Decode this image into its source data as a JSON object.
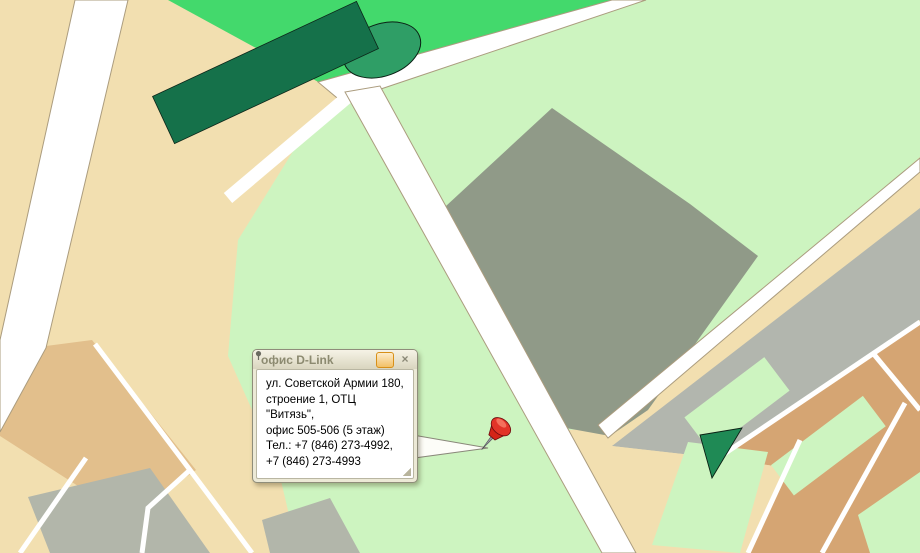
{
  "popup": {
    "title": "офис D-Link",
    "lines": [
      "ул. Советской Армии 180,",
      "строение 1, ОТЦ \"Витязь\",",
      "офис 505-506 (5 этаж)",
      "Тел.: +7 (846) 273-4992,",
      "+7 (846) 273-4993"
    ],
    "close_label": "×",
    "icons": {
      "pin_button": "pushpin-icon",
      "close_button": "close-icon"
    }
  },
  "colors": {
    "background_beige": "#f2dfb0",
    "park_green": "#43d96c",
    "residential_green": "#cdf4c0",
    "industrial_gray": "#909a88",
    "railway_gray": "#b2b6ae",
    "suburb_tan": "#d5a573",
    "street_label_red": "#a5161c",
    "marked_building_red": "#cf1d2c",
    "bus_stop_blue": "#2334d6",
    "traffic_light": [
      "#f01800",
      "#ffd800",
      "#2ecc10"
    ]
  },
  "map": {
    "street_labels": [
      {
        "text": "Московское шоссе",
        "x": 43,
        "y": 233,
        "rot": -63,
        "cls": "major"
      },
      {
        "text": "Стара Загора",
        "x": 534,
        "y": 42,
        "rot": -27,
        "cls": "major"
      },
      {
        "text": "проспект Карла Маркса",
        "x": 845,
        "y": 237,
        "rot": -37,
        "cls": "major"
      },
      {
        "text": "Фуражный пер.",
        "x": 146,
        "y": 392,
        "rot": 47,
        "cls": "minor"
      },
      {
        "text": "Центральная",
        "x": 40,
        "y": 523,
        "rot": -37,
        "cls": "minor"
      },
      {
        "text": "Са",
        "x": 150,
        "y": 533,
        "rot": 70,
        "cls": "major"
      },
      {
        "text": "Лоцманский пер.",
        "x": 838,
        "y": 503,
        "rot": 57,
        "cls": "minor"
      },
      {
        "text": "Свияжский п.",
        "x": 795,
        "y": 525,
        "rot": 57,
        "cls": "minor"
      },
      {
        "text": "Смол.",
        "x": 910,
        "y": 436,
        "rot": 57,
        "cls": "minor"
      }
    ],
    "building_labels": [
      {
        "text": "27",
        "x": 414,
        "y": 176
      },
      {
        "text": "27",
        "x": 441,
        "y": 153
      },
      {
        "text": "27",
        "x": 457,
        "y": 142
      },
      {
        "text": "77",
        "x": 224,
        "y": 74
      },
      {
        "text": "77",
        "x": 176,
        "y": 105
      },
      {
        "text": "77",
        "x": 148,
        "y": 125
      },
      {
        "text": "21",
        "x": 303,
        "y": 223
      },
      {
        "text": "23",
        "x": 332,
        "y": 237
      },
      {
        "text": "17в",
        "x": 728,
        "y": 141
      },
      {
        "text": "181а",
        "x": 602,
        "y": 343
      },
      {
        "text": "180к1",
        "x": 486,
        "y": 447
      },
      {
        "text": "16а",
        "x": 689,
        "y": 516
      },
      {
        "text": "17",
        "x": 741,
        "y": 504
      },
      {
        "text": "2",
        "x": 352,
        "y": 122
      }
    ],
    "bus_stops": [
      [
        357,
        131
      ],
      [
        480,
        90
      ],
      [
        531,
        318
      ],
      [
        536,
        395
      ],
      [
        766,
        296
      ],
      [
        649,
        472
      ]
    ],
    "traffic_lights": [
      [
        390,
        169
      ],
      [
        432,
        227
      ],
      [
        574,
        421
      ]
    ],
    "houses": [
      [
        876,
        357
      ],
      [
        897,
        339
      ],
      [
        914,
        326
      ],
      [
        840,
        420
      ],
      [
        792,
        463
      ],
      [
        810,
        450
      ],
      [
        828,
        438
      ],
      [
        775,
        478
      ],
      [
        880,
        507
      ],
      [
        862,
        520
      ],
      [
        848,
        533
      ],
      [
        30,
        456
      ],
      [
        88,
        458
      ],
      [
        108,
        498
      ],
      [
        552,
        88
      ],
      [
        58,
        68
      ],
      [
        42,
        331
      ],
      [
        185,
        62
      ],
      [
        685,
        435
      ]
    ],
    "buildings": [
      [
        268,
        70,
        225,
        52,
        -25,
        "m",
        [
          95,
          22,
          "#f2dfb0"
        ]
      ],
      [
        172,
        122,
        115,
        50,
        -25,
        "m",
        [
          48,
          20,
          "#f2dfb0"
        ]
      ],
      [
        230,
        182,
        95,
        48,
        -25,
        "m",
        [
          40,
          18,
          "#f2dfb0"
        ]
      ],
      [
        282,
        207,
        85,
        24,
        -25,
        "m"
      ],
      [
        327,
        240,
        85,
        24,
        -25,
        "m"
      ],
      [
        256,
        257,
        62,
        22,
        -25,
        "m"
      ],
      [
        302,
        302,
        78,
        22,
        -25,
        "m"
      ],
      [
        270,
        332,
        68,
        22,
        -25,
        "m"
      ],
      [
        350,
        267,
        55,
        20,
        -25,
        "m"
      ],
      [
        450,
        384,
        58,
        26,
        -25,
        "d"
      ],
      [
        420,
        352,
        40,
        20,
        -25,
        "d"
      ],
      [
        448,
        178,
        24,
        58,
        63,
        "m"
      ],
      [
        430,
        163,
        75,
        24,
        -18,
        "m"
      ],
      [
        470,
        148,
        48,
        20,
        -18,
        "m"
      ],
      [
        530,
        60,
        75,
        22,
        -18,
        "m"
      ],
      [
        587,
        82,
        58,
        20,
        -18,
        "m"
      ],
      [
        612,
        120,
        54,
        20,
        -18,
        "m"
      ],
      [
        545,
        95,
        18,
        16,
        -18,
        "m"
      ],
      [
        648,
        45,
        24,
        55,
        63,
        "m"
      ],
      [
        682,
        95,
        55,
        20,
        -18,
        "m"
      ],
      [
        705,
        18,
        40,
        16,
        -18,
        "m"
      ],
      [
        762,
        28,
        92,
        20,
        -37,
        "m"
      ],
      [
        830,
        62,
        92,
        20,
        -37,
        "m"
      ],
      [
        876,
        98,
        80,
        20,
        -37,
        "m"
      ],
      [
        908,
        132,
        60,
        18,
        -37,
        "m"
      ],
      [
        858,
        10,
        60,
        16,
        -37,
        "m"
      ],
      [
        800,
        172,
        58,
        18,
        -37,
        "m"
      ],
      [
        758,
        196,
        26,
        24,
        -37,
        "m"
      ],
      [
        814,
        210,
        64,
        18,
        -37,
        "m"
      ],
      [
        848,
        196,
        54,
        16,
        -37,
        "m"
      ],
      [
        884,
        162,
        44,
        16,
        -37,
        "m"
      ],
      [
        318,
        478,
        26,
        60,
        63,
        "m"
      ],
      [
        355,
        502,
        26,
        70,
        63,
        "m"
      ],
      [
        395,
        527,
        26,
        68,
        63,
        "m"
      ],
      [
        430,
        482,
        70,
        24,
        -25,
        "m"
      ],
      [
        470,
        517,
        68,
        24,
        -25,
        "m"
      ],
      [
        508,
        546,
        58,
        22,
        -25,
        "m"
      ],
      [
        522,
        472,
        26,
        54,
        63,
        "m"
      ],
      [
        546,
        507,
        26,
        58,
        63,
        "m"
      ],
      [
        185,
        516,
        30,
        74,
        63,
        "m"
      ],
      [
        225,
        502,
        30,
        80,
        63,
        "m"
      ],
      [
        268,
        527,
        26,
        58,
        63,
        "m"
      ],
      [
        300,
        492,
        78,
        26,
        -25,
        "m"
      ],
      [
        335,
        542,
        56,
        22,
        -25,
        "m"
      ],
      [
        686,
        508,
        26,
        60,
        60,
        "m"
      ],
      [
        734,
        496,
        26,
        66,
        60,
        "m"
      ],
      [
        752,
        452,
        36,
        15,
        -37,
        "m"
      ],
      [
        664,
        470,
        28,
        14,
        -30,
        "m"
      ],
      [
        885,
        528,
        30,
        14,
        -37,
        "m"
      ],
      [
        906,
        505,
        26,
        13,
        -37,
        "m"
      ],
      [
        912,
        545,
        22,
        12,
        -37,
        "m"
      ],
      [
        736,
        400,
        55,
        18,
        -37,
        "m"
      ],
      [
        712,
        417,
        16,
        13,
        -37,
        "m"
      ],
      [
        800,
        452,
        36,
        15,
        -37,
        "d"
      ],
      [
        840,
        440,
        30,
        14,
        -37,
        "m"
      ],
      [
        872,
        430,
        26,
        13,
        -37,
        "m"
      ],
      [
        12,
        62,
        16,
        54,
        60,
        "d"
      ],
      [
        30,
        106,
        16,
        58,
        60,
        "d"
      ],
      [
        20,
        170,
        16,
        78,
        63,
        "d"
      ],
      [
        42,
        216,
        14,
        54,
        63,
        "d"
      ],
      [
        108,
        30,
        14,
        38,
        63,
        "d"
      ],
      [
        312,
        30,
        42,
        28,
        -18,
        "d",
        [
          18,
          12,
          "#43d96c"
        ]
      ],
      [
        97,
        250,
        32,
        165,
        65,
        "b"
      ],
      [
        150,
        316,
        30,
        88,
        65,
        "b"
      ],
      [
        200,
        334,
        26,
        52,
        65,
        "b"
      ],
      [
        226,
        382,
        24,
        44,
        65,
        "b"
      ],
      [
        737,
        128,
        62,
        44,
        -37,
        "u",
        [
          30,
          18,
          "#cdf4c0"
        ]
      ],
      [
        800,
        68,
        48,
        14,
        -37,
        "p"
      ],
      [
        800,
        68,
        14,
        42,
        -37,
        "p"
      ],
      [
        724,
        216,
        13,
        30,
        -37,
        "p"
      ],
      [
        596,
        336,
        70,
        32,
        -20,
        "m"
      ],
      [
        614,
        356,
        32,
        28,
        -20,
        "m"
      ],
      [
        572,
        222,
        22,
        16,
        -20,
        "g"
      ],
      [
        597,
        200,
        27,
        18,
        -20,
        "g"
      ],
      [
        586,
        247,
        16,
        12,
        -20,
        "g"
      ],
      [
        622,
        251,
        42,
        24,
        -20,
        "g"
      ],
      [
        650,
        232,
        18,
        14,
        -20,
        "g"
      ],
      [
        610,
        292,
        56,
        42,
        -20,
        "g"
      ],
      [
        657,
        322,
        30,
        20,
        -20,
        "g"
      ],
      [
        580,
        306,
        24,
        16,
        -20,
        "g"
      ],
      [
        562,
        186,
        20,
        14,
        -20,
        "g"
      ],
      [
        612,
        162,
        30,
        16,
        -18,
        "g"
      ],
      [
        662,
        182,
        22,
        14,
        -18,
        "g"
      ],
      [
        692,
        226,
        20,
        14,
        -37,
        "g"
      ],
      [
        702,
        302,
        26,
        68,
        53,
        "g"
      ],
      [
        648,
        366,
        40,
        22,
        -37,
        "g"
      ],
      [
        620,
        392,
        28,
        16,
        -37,
        "g"
      ],
      [
        497,
        302,
        30,
        20,
        -20,
        "g"
      ],
      [
        522,
        352,
        26,
        16,
        -20,
        "g"
      ],
      [
        542,
        392,
        22,
        16,
        -20,
        "g"
      ],
      [
        472,
        252,
        24,
        16,
        -20,
        "g"
      ],
      [
        516,
        228,
        20,
        14,
        -20,
        "g"
      ],
      [
        730,
        278,
        22,
        44,
        53,
        "g"
      ],
      [
        100,
        512,
        140,
        14,
        -20,
        "i"
      ],
      [
        125,
        538,
        140,
        12,
        -20,
        "i"
      ],
      [
        300,
        530,
        40,
        12,
        -20,
        "i"
      ],
      [
        316,
        548,
        36,
        10,
        -20,
        "i"
      ],
      [
        255,
        468,
        36,
        15,
        -20,
        "m"
      ],
      [
        272,
        500,
        20,
        13,
        -20,
        "m"
      ],
      [
        506,
        416,
        15,
        46,
        6,
        "b"
      ],
      [
        487,
        456,
        58,
        24,
        -28,
        "r"
      ]
    ]
  }
}
